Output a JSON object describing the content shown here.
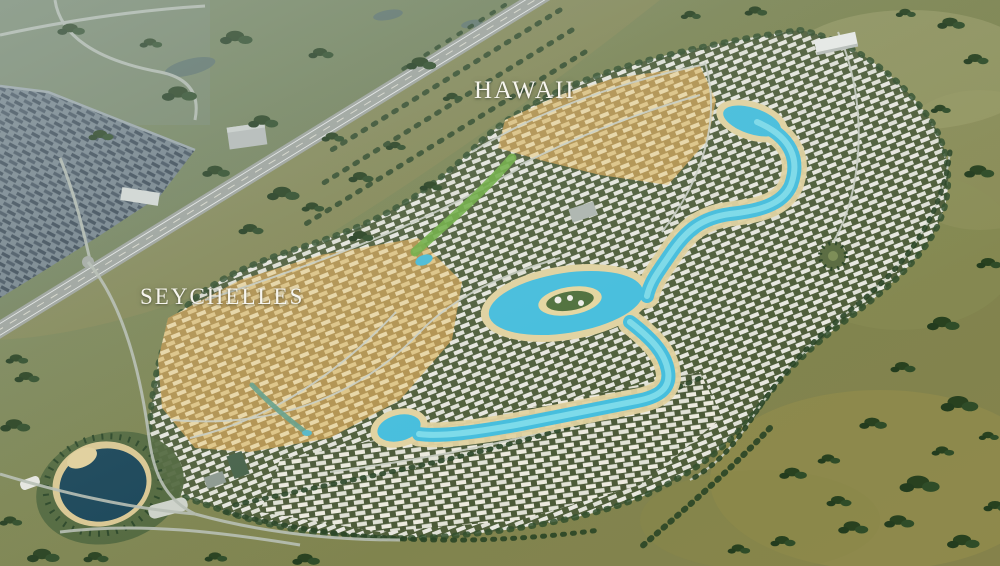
{
  "scene": {
    "kind": "aerial-masterplan-render",
    "districts": [
      {
        "id": "hawaii",
        "label": "HAWAII"
      },
      {
        "id": "seychelles",
        "label": "SEYCHELLES"
      }
    ],
    "labels": {
      "hawaii": "HAWAII",
      "seychelles": "SEYCHELLES"
    },
    "palette": {
      "field_olive": "#7d8551",
      "field_cool_green": "#6d7f5e",
      "field_golden": "#97904c",
      "tree_dark_green": "#2a4526",
      "street_green": "#4f5e3a",
      "villa_white": "#e7e7df",
      "tan_housing": "#ead7a6",
      "tan_base": "#b3934f",
      "lagoon_turquoise": "#45bedd",
      "lagoon_light": "#86e0ec",
      "beach_sand": "#e2d3a0",
      "park_lake_navy": "#184457",
      "highway_gray": "#9fa49d",
      "city_roof_slate": "#3a4854",
      "label_white": "#f7f5ee"
    }
  }
}
